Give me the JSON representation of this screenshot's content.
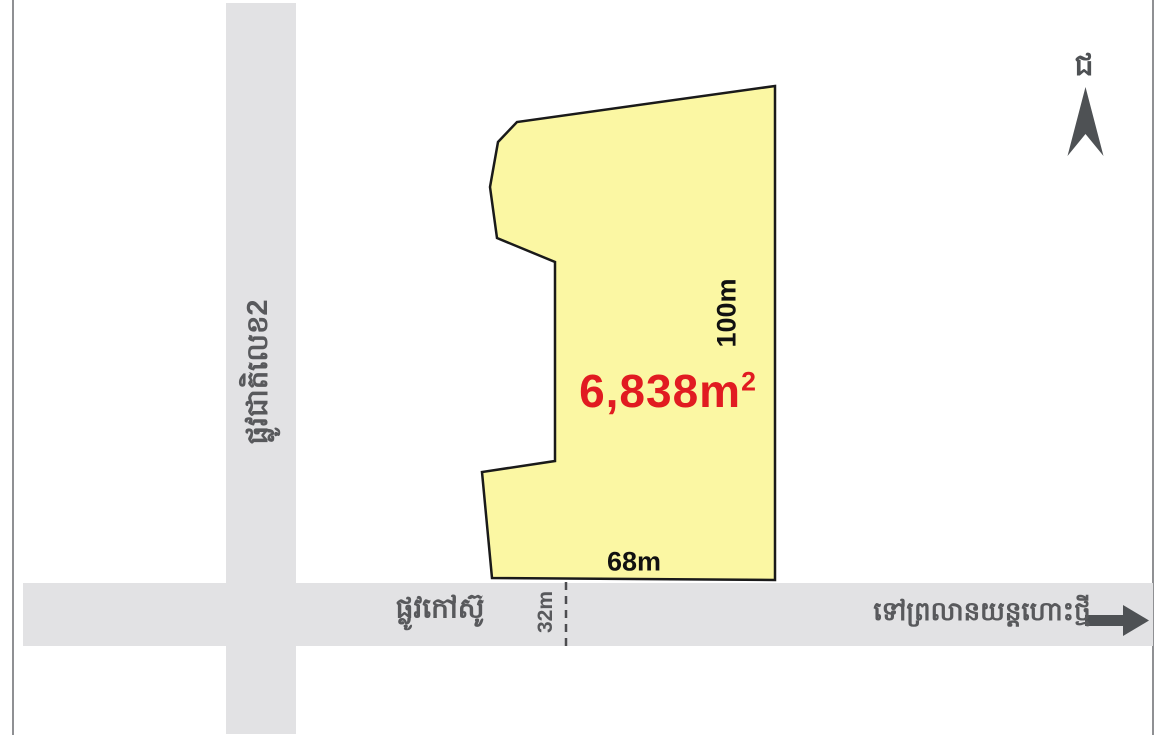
{
  "colors": {
    "plot_fill": "#FBF7A3",
    "plot_stroke": "#1A1A1A",
    "area_text": "#E11B21",
    "road_fill": "#E2E2E4",
    "road_label": "#58595C",
    "dimension_text": "#111111",
    "dash_line": "#4D4D50",
    "compass": "#4E5154"
  },
  "plot": {
    "area_label": "6,838m",
    "area_superscript": "2",
    "right_side_length": "100m",
    "bottom_side_length": "68m"
  },
  "roads": {
    "vertical_road_name": "ផ្លូវជាតិលេខ2",
    "horizontal_road_name": "ផ្លូវកៅស៊ូ",
    "horizontal_road_width": "32m",
    "destination_text": "ទៅព្រលានយន្តហោះថ្មី"
  },
  "compass": {
    "north_label": "ជ"
  }
}
